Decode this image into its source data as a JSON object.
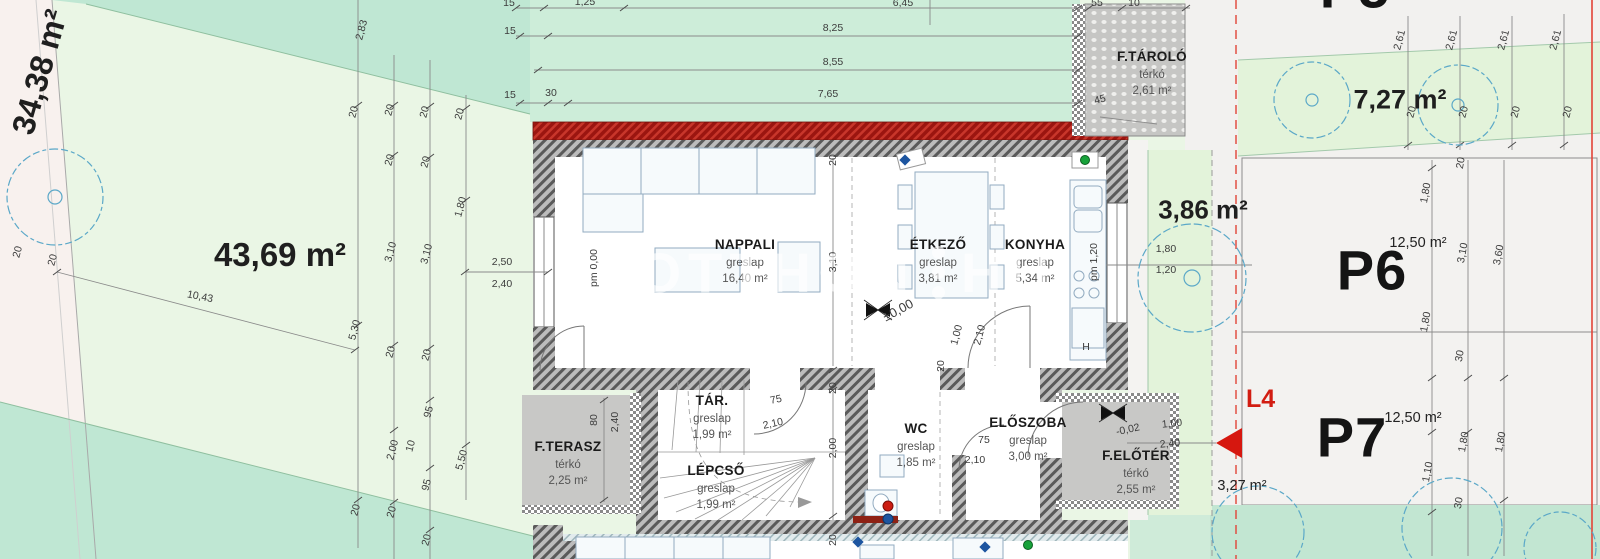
{
  "areas": {
    "left_strip": "34,38 m²",
    "garden": "43,69 m²",
    "side_green": "3,86 m²",
    "upper_right": "7,27 m²",
    "l4_area": "3,27 m²"
  },
  "rooms": [
    {
      "name": "NAPPALI",
      "finish": "greslap",
      "area": "16,40 m²"
    },
    {
      "name": "ÉTKEZŐ",
      "finish": "greslap",
      "area": "3,81 m²"
    },
    {
      "name": "KONYHA",
      "finish": "greslap",
      "area": "5,34 m²"
    },
    {
      "name": "TÁR.",
      "finish": "greslap",
      "area": "1,99 m²"
    },
    {
      "name": "LÉPCSŐ",
      "finish": "greslap",
      "area": "1,99 m²"
    },
    {
      "name": "WC",
      "finish": "greslap",
      "area": "1,85 m²"
    },
    {
      "name": "ELŐSZOBA",
      "finish": "greslap",
      "area": "3,00 m²"
    },
    {
      "name": "F.TERASZ",
      "finish": "térkó",
      "area": "2,25 m²"
    },
    {
      "name": "F.ELŐTÉR",
      "finish": "térkó",
      "area": "2,55 m²"
    },
    {
      "name": "F.TÁROLÓ",
      "finish": "térkó",
      "area": "2,61 m²"
    }
  ],
  "parking": {
    "p5": "P5",
    "p6": "P6",
    "p6_area": "12,50 m²",
    "p7": "P7",
    "p7_area": "12,50 m²"
  },
  "marker": {
    "label": "L4"
  },
  "watermark": {
    "left": "UJOTTHON",
    "right": "HU"
  },
  "colors": {
    "garden": "#eaf6e5",
    "teal": "#bfe7d3",
    "wall_red": "#9b1510",
    "paving": "#c8c8c6",
    "boundary_red": "#e24438",
    "accent_red": "#d6170f"
  },
  "dims": [
    "15",
    "1,25",
    "6,45",
    "15",
    "8,25",
    "8,55",
    "15",
    "30",
    "7,65",
    "55",
    "10",
    "2,83",
    "45",
    "2,61",
    "2,61",
    "2,61",
    "2,61",
    "20",
    "20",
    "20",
    "20",
    "20",
    "20",
    "20",
    "20",
    "20",
    "20",
    "1,80",
    "3,10",
    "3,10",
    "2,50",
    "2,40",
    "5,30",
    "20",
    "20",
    "95",
    "2,00",
    "10",
    "95",
    "5,50",
    "20",
    "20",
    "20",
    "10,43",
    "20",
    "3,10",
    "20",
    "2,00",
    "20",
    "pm 0,00",
    "pm 1,20",
    "±0,00",
    "1,00",
    "2,10",
    "75",
    "2,10",
    "80",
    "2,40",
    "75",
    "2,10",
    "-0,02",
    "1,00",
    "2,40",
    "1,80",
    "1,20",
    "20",
    "1,80",
    "3,10",
    "3,60",
    "1,80",
    "30",
    "1,10",
    "1,80",
    "1,80",
    "30",
    "20",
    "H",
    "20",
    "20"
  ]
}
